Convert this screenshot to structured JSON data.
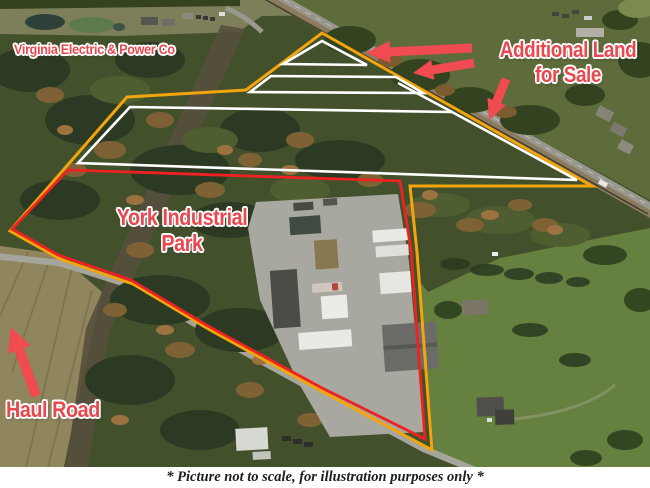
{
  "labels": {
    "power_company": "Virginia Electric & Power Co",
    "additional_land": {
      "line1": "Additional Land",
      "line2": "for Sale"
    },
    "industrial_park": {
      "line1": "York Industrial",
      "line2": "Park"
    },
    "haul_road": "Haul Road"
  },
  "caption": "* Picture not to scale, for illustration purposes only *",
  "colors": {
    "label_red": "#e9484f",
    "arrow_red": "#ef4b50",
    "boundary_outer_orange": "#f2a50c",
    "boundary_parcels_white": "#ffffff",
    "boundary_industrial_red": "#ee2222",
    "caption_text": "#1d1d1b"
  },
  "icons": {
    "arrow_additional_1": "arrow-pointing-left",
    "arrow_additional_2": "arrow-pointing-left",
    "arrow_additional_3": "arrow-pointing-down-left",
    "arrow_haul_road": "arrow-pointing-up-left"
  }
}
